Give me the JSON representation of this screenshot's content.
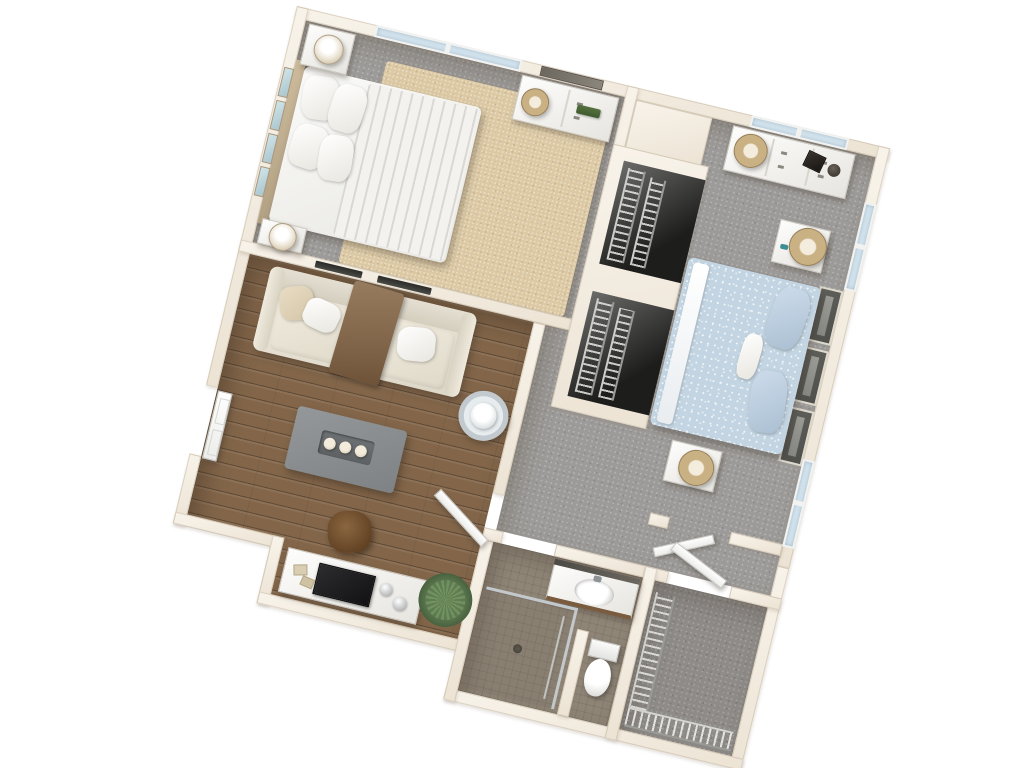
{
  "scene": {
    "type": "3d-floor-plan-render",
    "label": "3D top-down floor plan of a one-bedroom-plus-den apartment, rotated slightly clockwise on a white background",
    "rotation_deg": 13.5,
    "no_visible_text": true
  },
  "palette": {
    "background": "#ffffff",
    "wall": "#f1e9dd",
    "wall_edge": "#d9cfc0",
    "carpet_gray": "#9d9b99",
    "carpet_dark": "#8e8b88",
    "wood_floor": "#83664a",
    "tile_floor": "#8f8577",
    "rug_beige": "#dcc9a4",
    "bedding_white": "#f2f1ee",
    "bedding_blue": "#c2d4e2",
    "sofa_ivory": "#e9e4d8",
    "throw_brown": "#8d7257",
    "table_gray": "#898d8e",
    "accent_green": "#5d7a52",
    "fixture_white": "#fafafa"
  },
  "rooms": {
    "bedroom1": {
      "label": "Bedroom 1 (top left) — gray carpet with beige area rug",
      "items": {
        "bed": "Queen bed, white striped duvet, four white pillows, headboard on left wall",
        "nightstand_top": "White nightstand with white table lamp (top corner)",
        "nightstand_bottom": "White nightstand with white table lamp (bottom corner)",
        "dresser": "White 6-drawer dresser with woven-shade lamp and green plant decor",
        "mirror": "Dark framed mirror on top wall above dresser",
        "artwork": "Four light-blue framed prints above headboard on left wall",
        "window": "Double window on top wall",
        "rug": "Beige area rug"
      }
    },
    "bedroom2": {
      "label": "Bedroom 2 (top right) — gray carpet",
      "items": {
        "bed": "Queen bed, light-blue patterned duvet, blue pillows, paneled headboard on right wall",
        "nightstand_upper": "White nightstand with woven-shade lamp (above bed)",
        "nightstand_lower": "White nightstand with woven-shade lamp (below bed)",
        "dresser": "White wide 6-drawer dresser with woven lamp, dark picture frame and round box",
        "window_top": "Window on top wall",
        "windows_right": "Two windows on right wall",
        "door": "White door swung open at bottom doorway"
      }
    },
    "living": {
      "label": "Living room (left middle) — hardwood floor",
      "items": {
        "sofa": "Ivory three-seat sofa with brown throw blanket and white/beige pillows",
        "coffee_table": "Gray rectangular coffee table with tray of three candles",
        "side_table": "Round metal-and-glass side table with white lamp",
        "tv_stand": "White media console with flat TV and silver decor",
        "ottoman": "Brown leather ottoman stool",
        "plant": "Green potted plant in corner",
        "entry_door": "White entry door open against left wall",
        "hall_door": "White interior door swung into room near hallway opening",
        "wall_slots": "Two dark recessed panels on wall above sofa"
      }
    },
    "hallway": {
      "label": "Hallway / open carpeted circulation between rooms",
      "items": {
        "closet_a": "Reach-in closet with wire shelving (upper)",
        "closet_b": "Reach-in closet with wire shelving (lower)"
      }
    },
    "bathroom": {
      "label": "Bathroom (bottom middle) — mosaic tile floor",
      "items": {
        "vanity": "White vanity with oval sink, faucet and dark backsplash strip",
        "shower": "Walk-in shower with chrome glass frame and center drain",
        "toilet": "White toilet behind privacy half-wall"
      }
    },
    "walkin": {
      "label": "Walk-in closet (bottom right) — dark gray carpet",
      "items": {
        "shelf_left": "Wire shelving rack along left wall",
        "shelf_bottom": "Wire shelving rack along bottom wall",
        "door": "White door swung open into hallway"
      }
    }
  }
}
